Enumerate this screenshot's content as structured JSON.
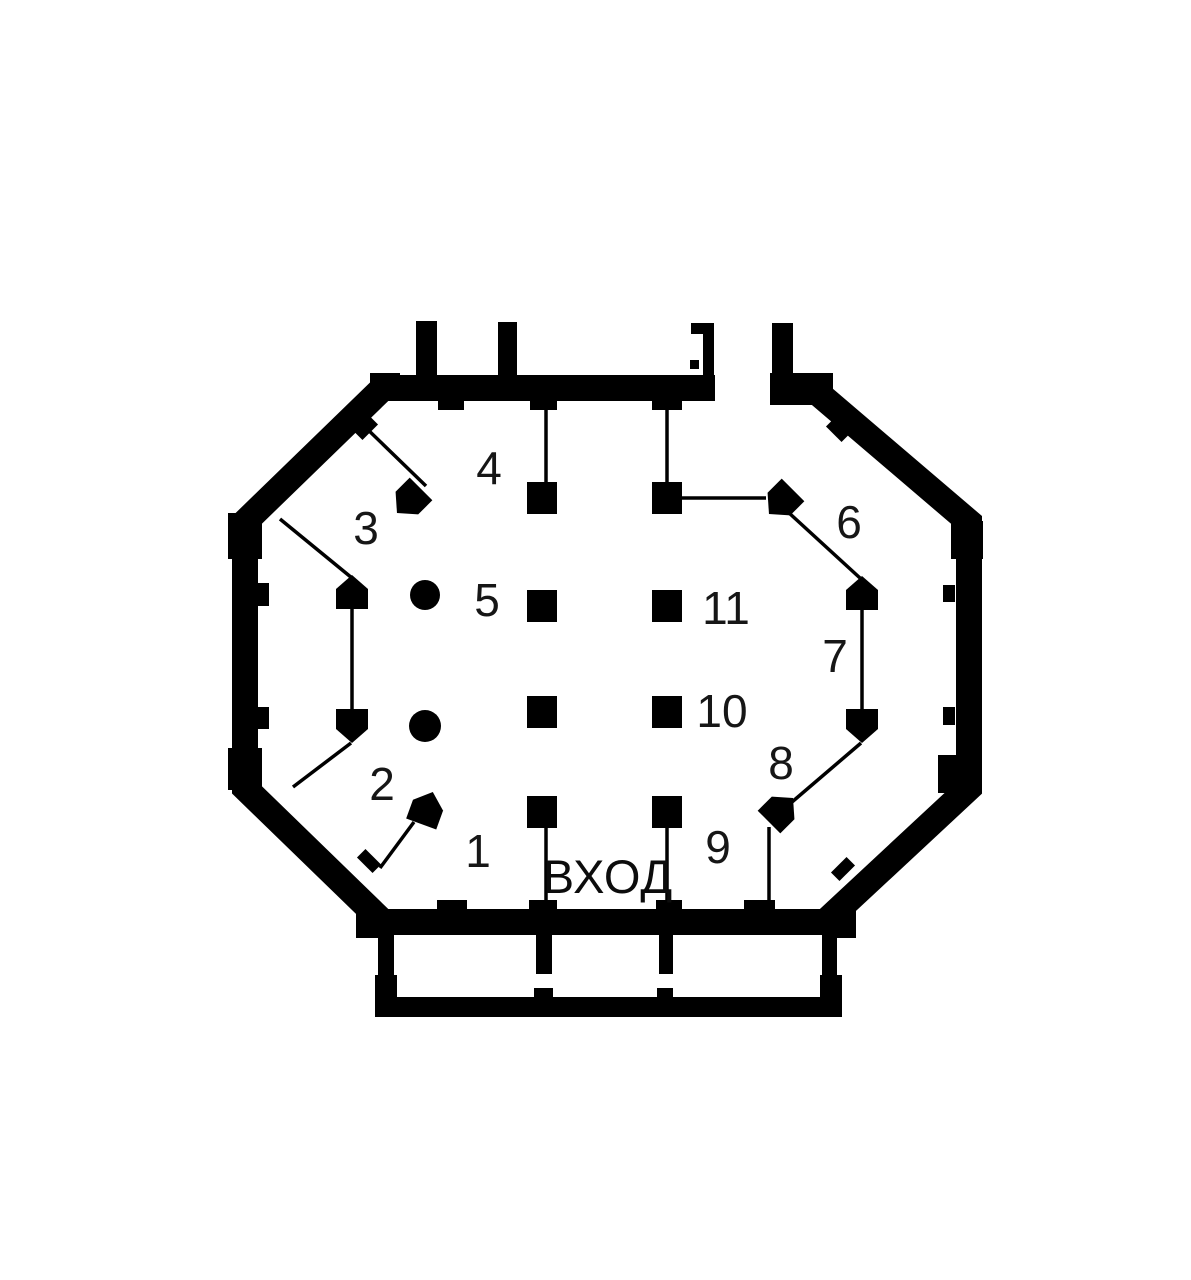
{
  "diagram": {
    "type": "floor-plan",
    "entrance_label": "ВХОД",
    "position_labels": [
      {
        "text": "1"
      },
      {
        "text": "2"
      },
      {
        "text": "3"
      },
      {
        "text": "4"
      },
      {
        "text": "5"
      },
      {
        "text": "6"
      },
      {
        "text": "7"
      },
      {
        "text": "8"
      },
      {
        "text": "9"
      },
      {
        "text": "10"
      },
      {
        "text": "11"
      }
    ],
    "counts": {
      "square_pillars": 8,
      "round_columns": 2,
      "wall_markers": 8,
      "leader_lines": 14
    },
    "colors": {
      "ink": "#000000",
      "background": "#ffffff"
    }
  }
}
